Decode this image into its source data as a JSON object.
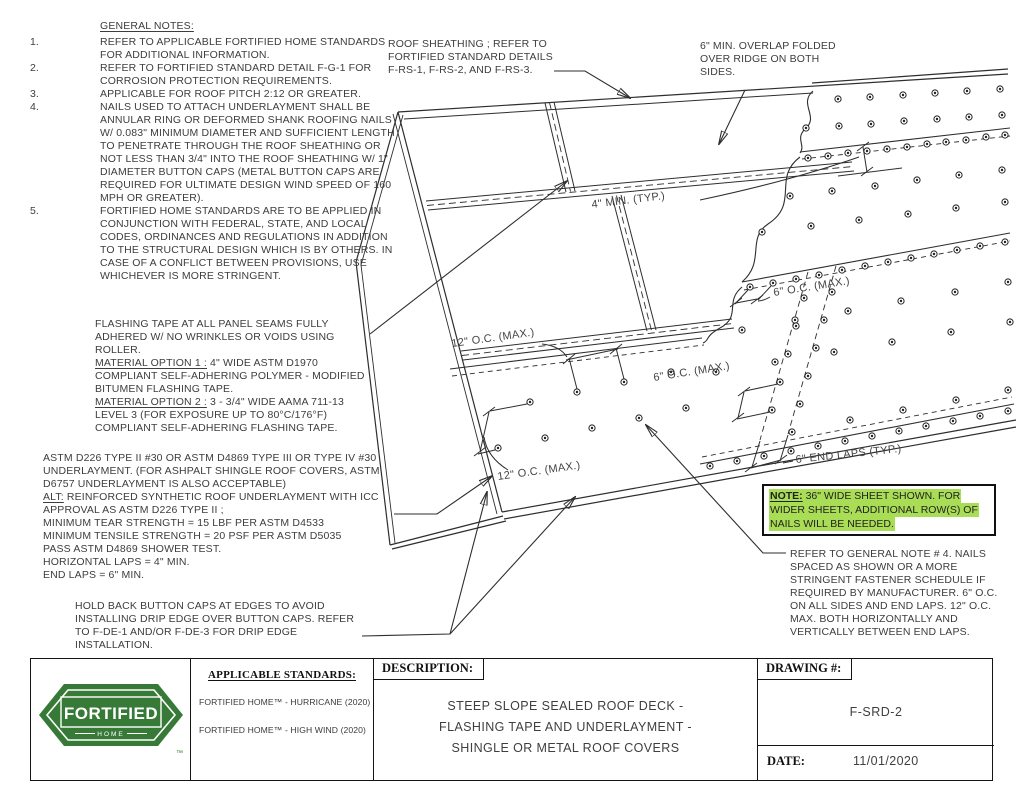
{
  "colors": {
    "brand_green": "#377a38",
    "note_highlight_green": "#a8dd55",
    "line_color": "#2e2e2e"
  },
  "general_notes": {
    "title": "GENERAL NOTES:",
    "items": [
      {
        "num": "1.",
        "text": "REFER TO APPLICABLE FORTIFIED HOME STANDARDS FOR ADDITIONAL INFORMATION."
      },
      {
        "num": "2.",
        "text": "REFER TO FORTIFIED STANDARD DETAIL F-G-1 FOR CORROSION PROTECTION REQUIREMENTS."
      },
      {
        "num": "3.",
        "text": "APPLICABLE FOR ROOF PITCH 2:12 OR GREATER."
      },
      {
        "num": "4.",
        "text": "NAILS USED TO ATTACH UNDERLAYMENT SHALL BE ANNULAR RING OR DEFORMED SHANK ROOFING NAILS W/ 0.083\" MINIMUM DIAMETER AND SUFFICIENT LENGTH TO PENETRATE THROUGH THE ROOF SHEATHING OR NOT LESS THAN 3/4\" INTO THE ROOF SHEATHING W/ 1\" DIAMETER BUTTON CAPS (METAL BUTTON CAPS ARE REQUIRED FOR ULTIMATE DESIGN WIND SPEED OF 160 MPH OR GREATER)."
      },
      {
        "num": "5.",
        "text": "FORTIFIED HOME STANDARDS ARE TO BE APPLIED IN CONJUNCTION WITH FEDERAL, STATE, AND LOCAL CODES, ORDINANCES AND REGULATIONS IN ADDITION TO THE STRUCTURAL DESIGN WHICH IS BY OTHERS. IN CASE OF A CONFLICT BETWEEN PROVISIONS, USE WHICHEVER IS MORE STRINGENT."
      }
    ]
  },
  "flashing_note": {
    "intro": "FLASHING TAPE AT ALL PANEL SEAMS FULLY ADHERED W/ NO WRINKLES OR VOIDS USING ROLLER.",
    "option1_label": "MATERIAL OPTION 1 :",
    "option1_text": " 4\" WIDE ASTM D1970 COMPLIANT SELF-ADHERING POLYMER - MODIFIED BITUMEN FLASHING TAPE.",
    "option2_label": "MATERIAL OPTION 2 :",
    "option2_text": " 3 - 3/4\" WIDE AAMA 711-13 LEVEL 3 (FOR EXPOSURE UP TO 80°C/176°F) COMPLIANT SELF-ADHERING FLASHING TAPE."
  },
  "underlayment_note": {
    "line1": "ASTM D226 TYPE II #30 OR ASTM D4869 TYPE III OR TYPE IV #30 UNDERLAYMENT. (FOR ASHPALT SHINGLE ROOF COVERS, ASTM D6757 UNDERLAYMENT IS ALSO ACCEPTABLE)",
    "alt_label": "ALT:",
    "alt_text": " REINFORCED SYNTHETIC ROOF UNDERLAYMENT WITH ICC APPROVAL AS ASTM D226 TYPE II ;",
    "line3": "MINIMUM TEAR STRENGTH = 15 LBF PER ASTM D4533",
    "line4": "MINIMUM TENSILE STRENGTH = 20 PSF PER ASTM D5035",
    "line5": "PASS ASTM D4869 SHOWER TEST.",
    "line6": "HORIZONTAL LAPS = 4\" MIN.",
    "line7": "END LAPS = 6\" MIN."
  },
  "holdback_note": "HOLD BACK BUTTON CAPS AT EDGES TO AVOID INSTALLING DRIP EDGE OVER BUTTON CAPS. REFER TO F-DE-1 AND/OR F-DE-3 FOR DRIP EDGE INSTALLATION.",
  "sheathing_note": "ROOF SHEATHING ; REFER TO FORTIFIED STANDARD DETAILS F-RS-1, F-RS-2, AND F-RS-3.",
  "overlap_note": "6\" MIN. OVERLAP FOLDED OVER RIDGE ON BOTH SIDES.",
  "green_note": {
    "label": "NOTE:",
    "rest1": " 36\" WIDE SHEET SHOWN. FOR",
    "line2": "WIDER SHEETS, ADDITIONAL ROW(S) OF",
    "line3": "NAILS WILL BE NEEDED."
  },
  "fastener_note": "REFER TO GENERAL NOTE # 4. NAILS SPACED AS SHOWN OR A MORE STRINGENT FASTENER SCHEDULE IF REQUIRED BY MANUFACTURER. 6\" O.C. ON ALL SIDES AND END LAPS. 12\" O.C. MAX. BOTH HORIZONTALLY AND VERTICALLY BETWEEN END LAPS.",
  "callouts": {
    "min4": "4\" MIN. (TYP.)",
    "oc6_a": "6\" O.C. (MAX.)",
    "oc6_b": "6\" O.C. (MAX.)",
    "oc12_a": "12\" O.C. (MAX.)",
    "oc12_b": "12\" O.C. (MAX.)",
    "endlaps": "6\" END LAPS (TYP.)"
  },
  "titleblock": {
    "logo_text": "FORTIFIED",
    "logo_sub": "HOME",
    "logo_tm": "™",
    "standards_title": "APPLICABLE STANDARDS:",
    "standard1": "FORTIFIED HOME™ - HURRICANE (2020)",
    "standard2": "FORTIFIED HOME™ - HIGH WIND (2020)",
    "description_label": "DESCRIPTION:",
    "description_line1": "STEEP SLOPE SEALED ROOF DECK -",
    "description_line2": "FLASHING TAPE AND UNDERLAYMENT -",
    "description_line3": "SHINGLE OR METAL ROOF COVERS",
    "drawing_label": "DRAWING #:",
    "drawing_number": "F-SRD-2",
    "date_label": "DATE:",
    "date_value": "11/01/2020"
  }
}
